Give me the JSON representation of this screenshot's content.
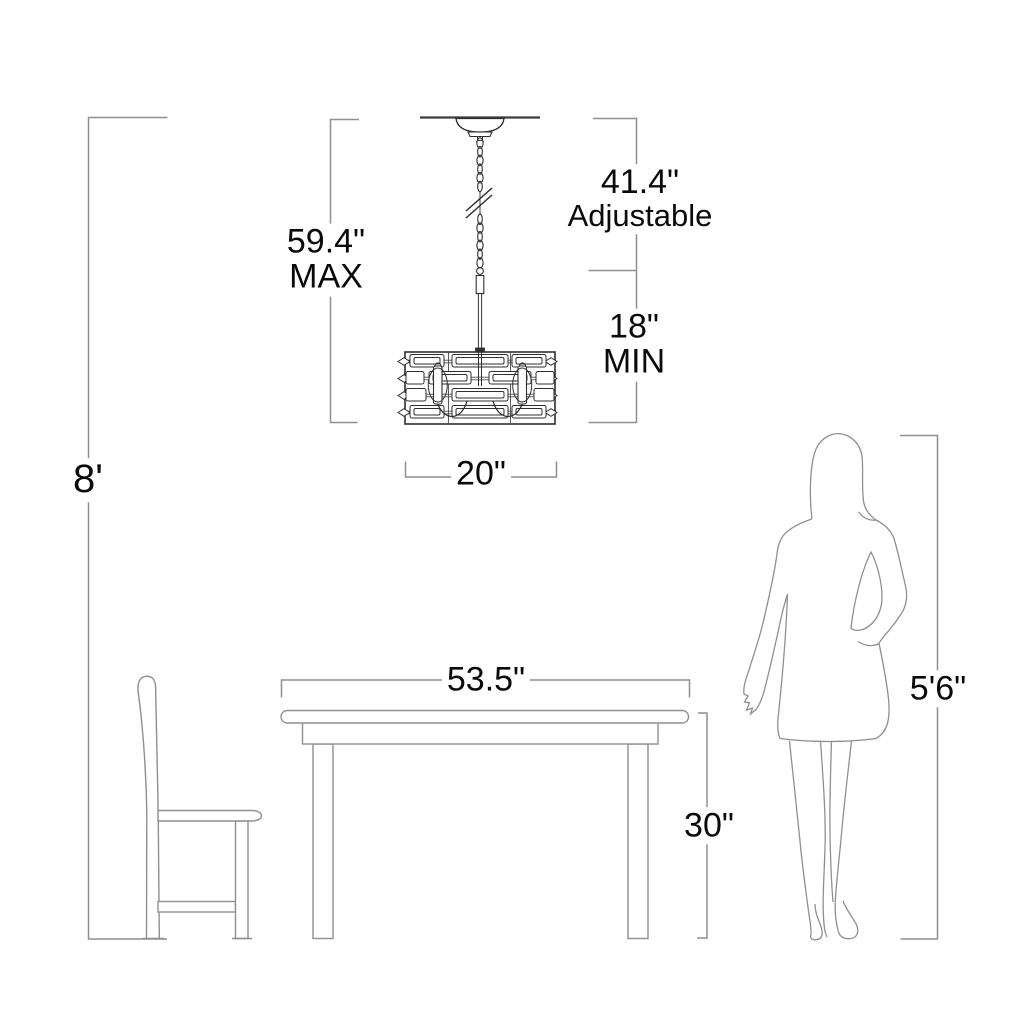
{
  "diagram": {
    "title": "chandelier-dining-scale-diagram",
    "subject": "Pendant chandelier shown over a dining table with side chair and standing figure for scale",
    "dimensions": {
      "ceiling_height": "8'",
      "fixture_max_value": "59.4\"",
      "fixture_max_qualifier": "MAX",
      "adjustable_value": "41.4\"",
      "adjustable_qualifier": "Adjustable",
      "min_value": "18\"",
      "min_qualifier": "MIN",
      "fixture_width": "20\"",
      "table_width": "53.5\"",
      "table_height": "30\"",
      "person_height": "5'6\""
    },
    "colors": {
      "background": "#ffffff",
      "dimension_line": "#8f8f8f",
      "furniture_line": "#8f8f8f",
      "fixture_line": "#2f2f2f",
      "ceiling_line": "#3c3c3c",
      "text": "#0a0a0a"
    },
    "objects": [
      "ceiling-line",
      "chandelier",
      "dining-table",
      "side-chair",
      "woman-silhouette"
    ]
  }
}
